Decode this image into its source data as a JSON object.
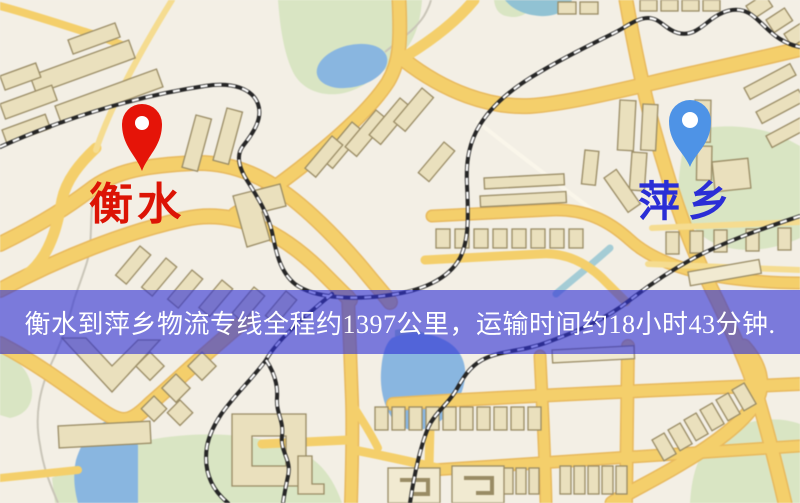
{
  "theme": {
    "map-bg": "#f3efe5",
    "road": "#f5cf68",
    "road-edge": "#e9b95a",
    "road-minor": "#f6dc8e",
    "building": "#eae0bc",
    "building-edge": "#998b63",
    "park": "#d9e5c2",
    "water": "#88b6e2",
    "water-teal": "#a9cfc2",
    "railway": "#262626",
    "banner-bg": "rgba(48,50,213,0.62)",
    "banner-text": "#ffffff"
  },
  "map": {
    "labels": {
      "origin": {
        "text": "衡水",
        "color": "#dc1405"
      },
      "destination": {
        "text": "萍乡",
        "color": "#2a2ed6"
      }
    },
    "markers": {
      "origin": {
        "color": "#e51408"
      },
      "destination": {
        "color": "#4e93e6"
      }
    }
  },
  "banner": {
    "text": "衡水到萍乡物流专线全程约1397公里，运输时间约18小时43分钟."
  }
}
